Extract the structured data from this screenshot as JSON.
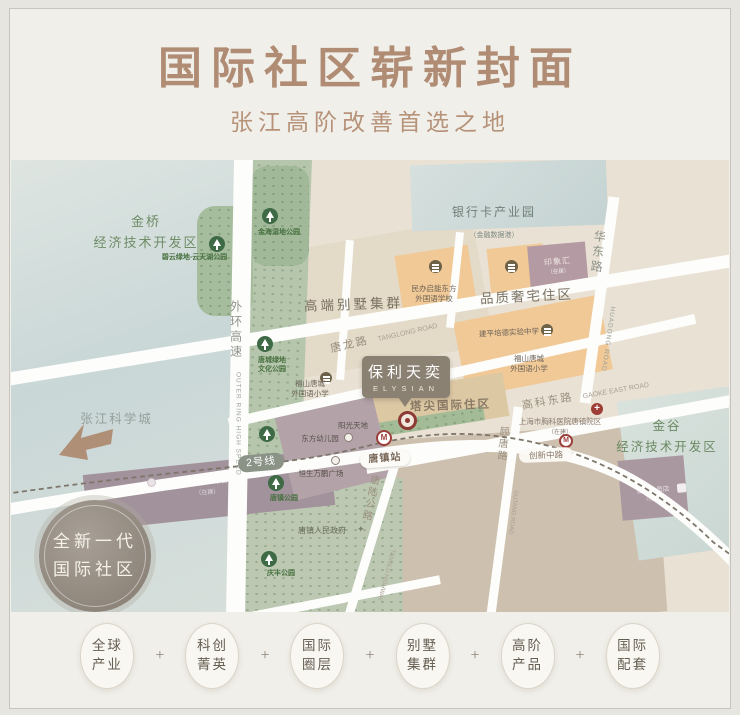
{
  "header": {
    "title": "国际社区崭新封面",
    "subtitle": "张江高阶改善首选之地"
  },
  "colors": {
    "title_brown": "#b08c74",
    "map_green_text": "#5f7d56",
    "metro_red": "#9c3f3a",
    "road_white": "#fdfdfb"
  },
  "map": {
    "areas": {
      "jinqiao_l1": "金桥",
      "jinqiao_l2": "经济技术开发区",
      "bankcard_l1": "银行卡产业园",
      "bankcard_l2": "（金融数据港）",
      "villa": "高端别墅集群",
      "quality": "品质奢宅住区",
      "jingu_l1": "金谷",
      "jingu_l2": "经济技术开发区",
      "pinnacle": "塔尖国际住区",
      "zhangjiang": "张江科学城",
      "badge_l1": "全新一代",
      "badge_l2": "国际社区"
    },
    "parks": {
      "biyun": "碧云绿地-云天湖公园",
      "jinhai": "金海湿地公园",
      "tangcheng_l1": "唐城绿地",
      "tangcheng_l2": "文化公园",
      "tangzhen": "唐镇公园",
      "qingfeng": "庆丰公园"
    },
    "roads": {
      "waihuan_cn": "外环高速",
      "waihuan_en": "OUTER RING HIGH SPEED",
      "huadong_cn": "华东路",
      "huadong_en": "HUADONG ROAD",
      "tanglong_cn": "唐龙路",
      "tanglong_en": "TANGLONG ROAD",
      "gaoke_cn": "高科东路",
      "gaoke_en": "GAOKE EAST ROAD",
      "gutang_cn": "顾唐路",
      "gutang_en": "GUTANG ROAD",
      "tanglu_cn": "唐陆公路",
      "tanglu_en": "TANGLU HIGHWAY"
    },
    "metro": {
      "line2": "2号线",
      "station_tangzhen": "唐镇站",
      "station_chuangxin": "创新中路",
      "logo_letter": "M"
    },
    "pois": {
      "school_qineng_l1": "民办启能东方",
      "school_qineng_l2": "外国语学校",
      "school_jianping": "建平培德实验中学",
      "school_fushan_r_l1": "福山唐城",
      "school_fushan_r_l2": "外国语小学",
      "school_fushan_l_l1": "福山唐城",
      "school_fushan_l_l2": "外国语小学",
      "yinxianghui": "印象汇",
      "yinxianghui_note": "（在建）",
      "yangguang": "阳光天地",
      "dongfang": "东方幼儿园",
      "hengsheng": "恒生万鹏广场",
      "guanglan": "广兰路100综合体",
      "guanglan_note": "（在建）",
      "government": "唐镇人民政府",
      "government_star": "✦",
      "sams": "山姆会员店",
      "sams_note": "（在建）",
      "hospital": "上海市胸科医院唐镇院区",
      "hospital_note": "（在建）",
      "hospital_cross": "+"
    },
    "project": {
      "name": "保利天奕",
      "en": "ELYSIAN"
    }
  },
  "footer": {
    "separator": "+",
    "items": [
      {
        "l1": "全球",
        "l2": "产业"
      },
      {
        "l1": "科创",
        "l2": "菁英"
      },
      {
        "l1": "国际",
        "l2": "圈层"
      },
      {
        "l1": "别墅",
        "l2": "集群"
      },
      {
        "l1": "高阶",
        "l2": "产品"
      },
      {
        "l1": "国际",
        "l2": "配套"
      }
    ]
  }
}
